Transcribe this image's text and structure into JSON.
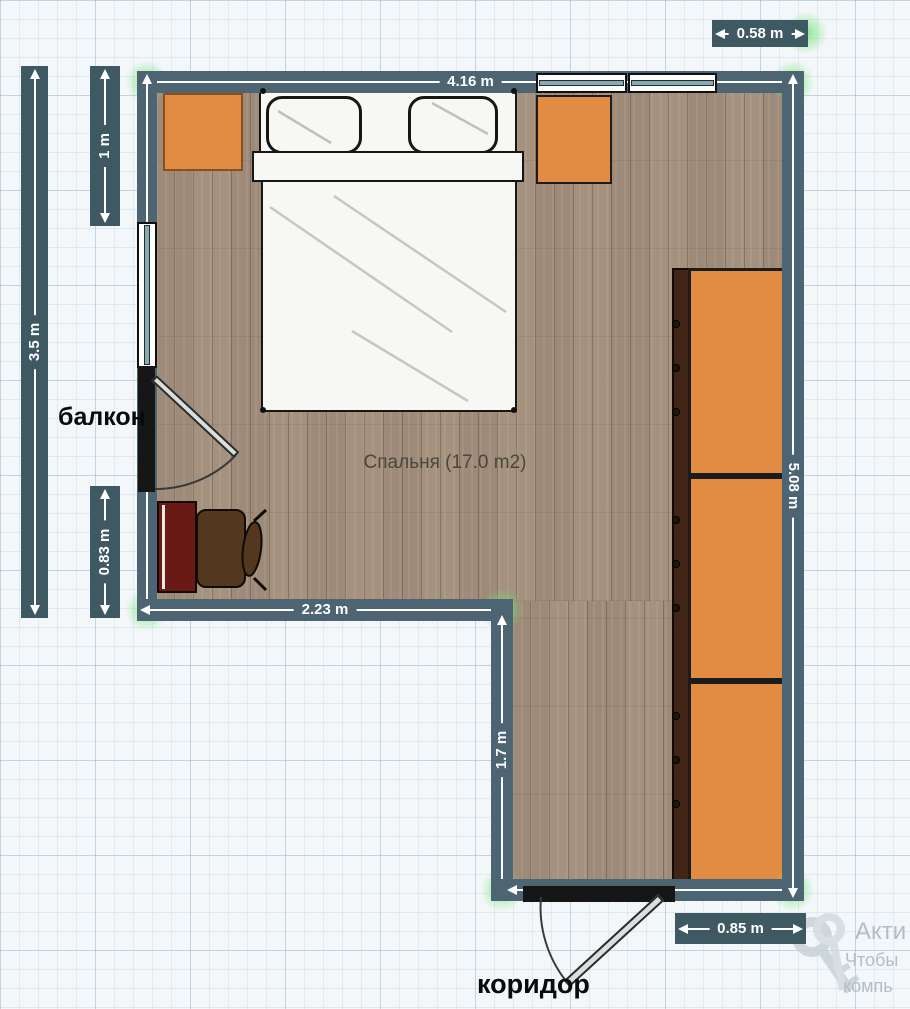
{
  "labels": {
    "room": "Спальня (17.0 m2)",
    "balcony": "балкон",
    "corridor": "коридор"
  },
  "dimensions": {
    "top_wall": "4.16 m",
    "top_right_offset": "0.58 m",
    "left_upper": "1 m",
    "left_total": "3.5 m",
    "left_lower": "0.83 m",
    "bottom_left_wall": "2.23 m",
    "corridor_wall": "1.7 m",
    "right_wall": "5.08 m",
    "door_offset": "0.85 m"
  },
  "watermark": {
    "icon": "key-icon",
    "line1": "Акти",
    "line2": "Чтобы",
    "line3": "компь"
  },
  "colors": {
    "wall": "#4d6572",
    "dim_box": "#3e5962",
    "floor_wood": "#a3917f",
    "furniture_orange": "#e28c43",
    "desk_red": "#691a15",
    "chair_brown": "#54371f",
    "window_pane": "#84acb4",
    "corner_glow": "#74e476",
    "dimension_text": "#ffffff"
  }
}
